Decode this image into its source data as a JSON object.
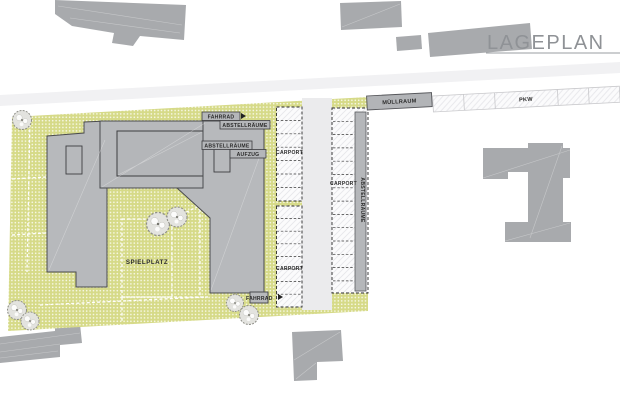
{
  "title": {
    "label": "LAGEPLAN"
  },
  "plan_labels": {
    "fahrrad_top": "FAHRRAD",
    "abstellraeume_top": "ABSTELLRÄUME",
    "abstellraeume_mid": "ABSTELLRÄUME",
    "aufzug": "AUFZUG",
    "carport_left_top": "CARPORT",
    "carport_left_bottom": "CARPORT",
    "carport_right": "CARPORT",
    "abstellraeume_vertical": "ABSTELLRÄUME",
    "muellraum": "MÜLLRAUM",
    "pkw": "PKW",
    "spielplatz": "SPIELPLATZ",
    "fahrrad_bottom": "FAHRRAD"
  },
  "colors": {
    "site_green": "#d6da88",
    "building_gray": "#b7b9bc",
    "context_gray": "#a8aaad",
    "outline": "#4a4b4e",
    "title_gray": "#8f9296",
    "road_gray": "#f1f1f3"
  }
}
